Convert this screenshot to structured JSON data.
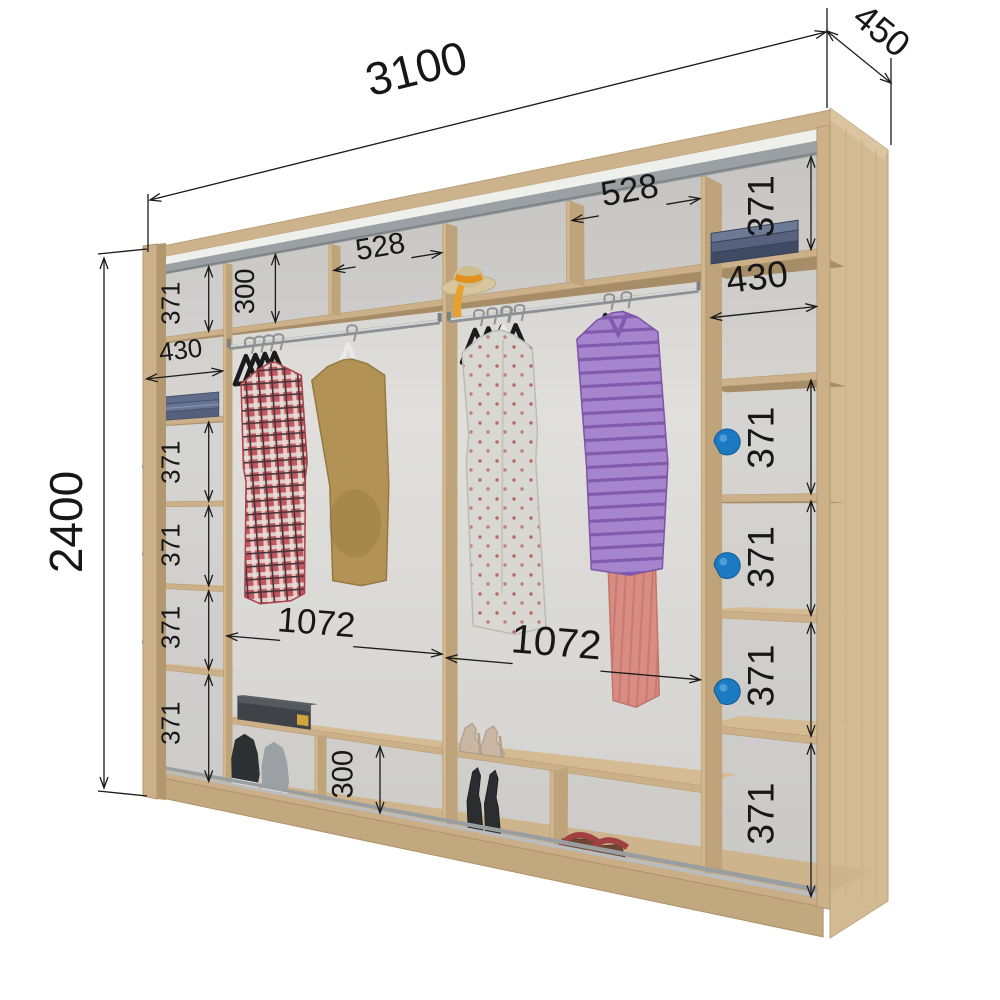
{
  "page": {
    "background": "#ffffff",
    "type": "wardrobe interior dimension diagram"
  },
  "colors": {
    "wood": "#cbb089",
    "wood_light": "#d9c29c",
    "wood_dark": "#b39872",
    "back_wall": "#dcdbd7",
    "dimension_lines": "#1a1a1a",
    "handle_blue": "#1b7ac2",
    "track_gray": "#9aa0a3"
  },
  "overall_dimensions": {
    "width_mm": "3100",
    "depth_mm": "450",
    "height_mm": "2400"
  },
  "left_column": {
    "sections": [
      {
        "label": "371",
        "content": "empty shelf cubby"
      },
      {
        "label": "430",
        "content": "folded jeans stack"
      },
      {
        "label": "371",
        "content": "cubby with blue handle"
      },
      {
        "label": "371",
        "content": "cubby with blue handle"
      },
      {
        "label": "371",
        "content": "cubby with blue handle"
      },
      {
        "label": "371",
        "content": "empty shelf cubby"
      }
    ]
  },
  "right_column": {
    "sections": [
      {
        "label": "371",
        "content": "folded towels stack"
      },
      {
        "label": "430",
        "content": "empty shelf cubby"
      },
      {
        "label": "371",
        "content": "cubby with blue handle"
      },
      {
        "label": "371",
        "content": "cubby with blue handle"
      },
      {
        "label": "371",
        "content": "cubby with blue handle"
      },
      {
        "label": "371",
        "content": "empty shelf cubby"
      }
    ]
  },
  "center_left": {
    "top_cubby_height": "300",
    "top_cubby_width": "528",
    "hanging_width": "1072",
    "shoe_cubby_height": "300",
    "contents": [
      "clothes rail with black hangers",
      "plaid shirt",
      "khaki sweater",
      "shoe box",
      "sneakers"
    ]
  },
  "center_right": {
    "top_cubby_width": "528",
    "hanging_width": "1072",
    "contents": [
      "straw hat",
      "clothes rail with hangers",
      "floral dress",
      "purple striped sweater",
      "pink skirt",
      "high heels",
      "wedge sandals",
      "brown sandals"
    ]
  },
  "handles": {
    "color": "#1b7ac2",
    "left_count": 3,
    "right_count": 3
  }
}
